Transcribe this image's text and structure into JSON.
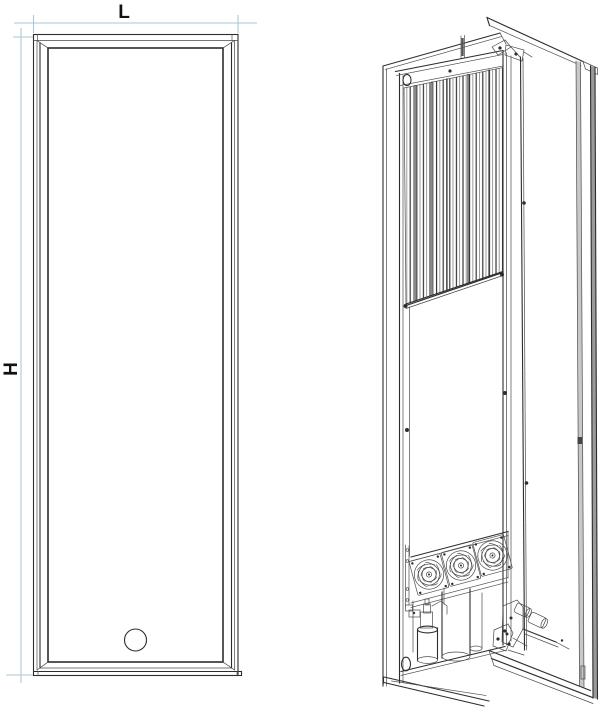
{
  "diagram": {
    "kind": "technical-line-drawing",
    "dimension_labels": {
      "width": "L",
      "height": "H"
    },
    "colors": {
      "line": "#2d2d2d",
      "dimension_line": "#aec6d6",
      "label_text": "#111111",
      "background": "#ffffff"
    },
    "front_view": {
      "width_label": "L",
      "height_label": "H",
      "features": [
        "beveled rectangular frame",
        "round knob near bottom center"
      ]
    },
    "isometric_view": {
      "fan_count": 3,
      "features": [
        "open side door",
        "vertical coil fins",
        "three fans",
        "filter drier cylinder",
        "service valves",
        "top hinge",
        "bottom hinge",
        "cable hole ovals"
      ]
    }
  }
}
